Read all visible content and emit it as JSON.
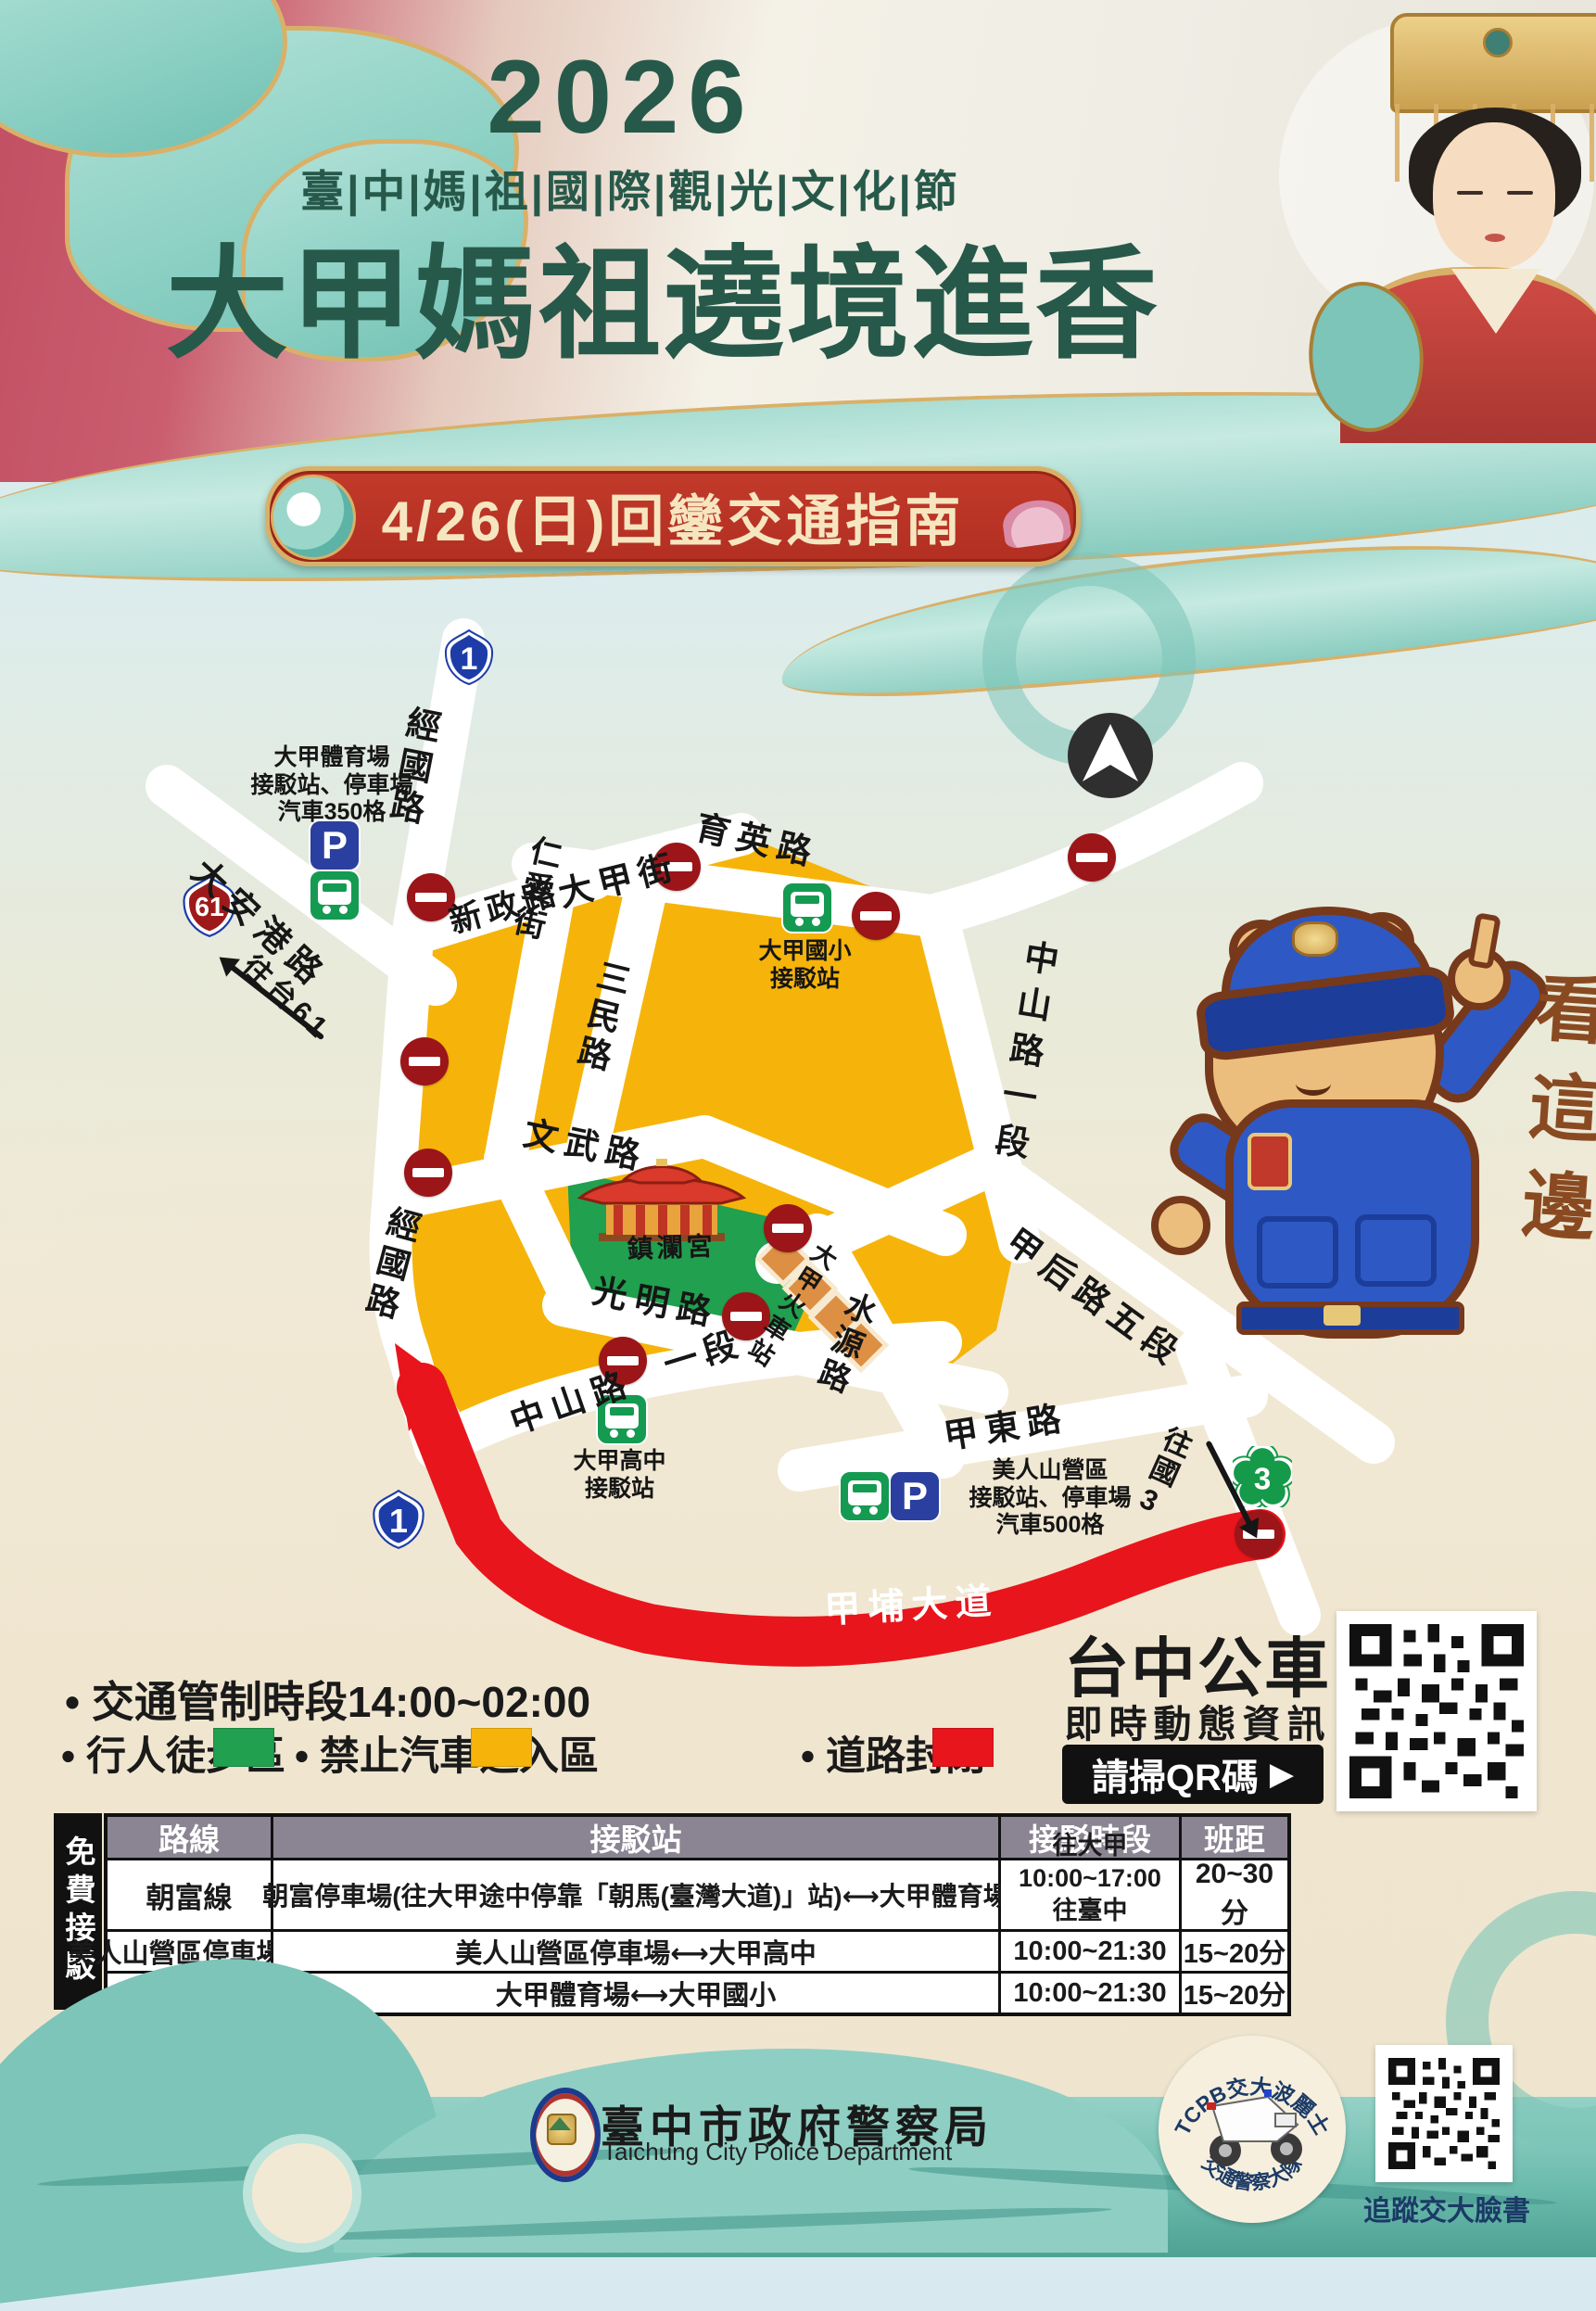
{
  "poster": {
    "year": "2026",
    "festival_title": "臺|中|媽|祖|國|際|觀|光|文|化|節",
    "main_title": "大甲媽祖遶境進香",
    "banner_title": "4/26(日)回鑾交通指南"
  },
  "map": {
    "road_labels": {
      "jingguo_n": "經國路",
      "daangang": "大安港路",
      "xinzheng": "新政路",
      "dajia_st": "大甲街",
      "yuying": "育英路",
      "renai": "仁愛街",
      "sanmin": "三民路",
      "zhongshan_1": "中山路一段",
      "wenwu": "文武路",
      "jingguo_s": "經國路",
      "guangming": "光明路",
      "zhongshan_sw": "中山路",
      "zhongshan_sw2": "一段",
      "shuiyuan": "水源路",
      "jiahou": "甲后路五段",
      "jiadong": "甲東路",
      "jiapu": "甲埔大道"
    },
    "poi": {
      "temple": "鎮瀾宮",
      "train_station": "大甲火車站"
    },
    "shields": {
      "provincial_1": "1",
      "provincial_61": "61",
      "national_3": "3"
    },
    "directions": {
      "to_tai61": "往台61",
      "to_guo3": "往國3"
    },
    "stops": {
      "stadium": {
        "line1": "大甲體育場",
        "line2": "接駁站、停車場",
        "line3": "汽車350格"
      },
      "elementary": {
        "line1": "大甲國小",
        "line2": "接駁站"
      },
      "highschool": {
        "line1": "大甲高中",
        "line2": "接駁站"
      },
      "meirenshan": {
        "line1": "美人山營區",
        "line2": "接駁站、停車場",
        "line3": "汽車500格"
      }
    },
    "mascot_callout": "看這邊",
    "icons": {
      "parking": "P"
    }
  },
  "legend": {
    "control_time": "• 交通管制時段14:00~02:00",
    "items": [
      {
        "label": "• 行人徒步區",
        "color": "#21A04F"
      },
      {
        "label": "• 禁止汽車進入區",
        "color": "#F6B40A"
      },
      {
        "label": "• 道路封閉",
        "color": "#E8151C"
      }
    ]
  },
  "bus_info": {
    "title": "台中公車",
    "subtitle": "即時動態資訊",
    "cta": "請掃QR碼",
    "cta_arrow": "▶"
  },
  "shuttle_table": {
    "side_label": "免費接駁",
    "headers": [
      "路線",
      "接駁站",
      "接駁時段",
      "班距"
    ],
    "rows": [
      {
        "route": "朝富線",
        "station": "朝富停車場(往大甲途中停靠「朝馬(臺灣大道)」站)⟷大甲體育場",
        "time1": "往大甲10:00~17:00",
        "time2": "往臺中13:00~22:00",
        "interval": "20~30分"
      },
      {
        "route": "美人山營區停車場線",
        "station": "美人山營區停車場⟷大甲高中",
        "time1": "10:00~21:30",
        "time2": "",
        "interval": "15~20分"
      },
      {
        "route": "大甲國小線",
        "station": "大甲體育場⟷大甲國小",
        "time1": "10:00~21:30",
        "time2": "",
        "interval": "15~20分"
      }
    ]
  },
  "footer": {
    "org_zh": "臺中市政府警察局",
    "org_en": "Taichung City Police Department",
    "logo_top": "TCPB交大波麗士",
    "logo_bottom": "交通警察大隊",
    "qr_label": "追蹤交大臉書"
  }
}
